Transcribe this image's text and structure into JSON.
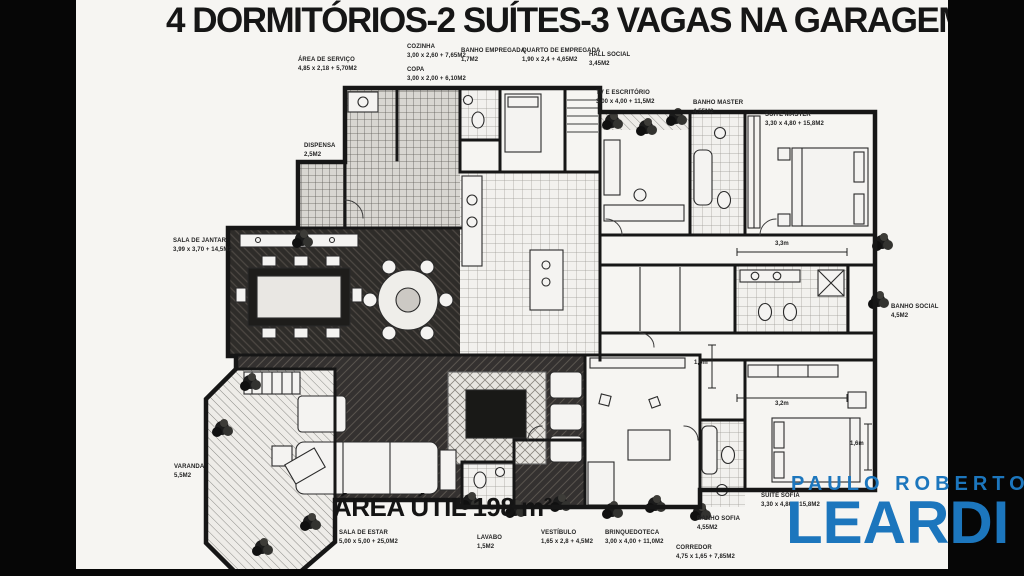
{
  "page": {
    "title": "4 DORMITÓRIOS-2 SUÍTES-3 VAGAS NA GARAGEM",
    "area_util": "ÁREA ÚTIL 198 m²"
  },
  "branding": {
    "line1": "PAULO ROBERTO",
    "line2": "LEARDI"
  },
  "colors": {
    "brand_blue": "#1c76bd",
    "letterbox": "#060606",
    "ink": "#1a1a1a"
  },
  "rooms": {
    "area_servico": {
      "name": "ÁREA DE SERVIÇO",
      "dims": "4,85 x 2,18 + 5,70M2"
    },
    "cozinha": {
      "name": "COZINHA",
      "dims": "3,00 x 2,60 + 7,65M2"
    },
    "copa": {
      "name": "COPA",
      "dims": "3,00 x 2,00 + 6,10M2"
    },
    "banho_empregada": {
      "name": "BANHO EMPREGADA",
      "dims": "1,7M2"
    },
    "quarto_empregada": {
      "name": "QUARTO DE EMPREGADA",
      "dims": "1,90 x 2,4 + 4,65M2"
    },
    "hall_social": {
      "name": "HALL SOCIAL",
      "dims": "3,45M2"
    },
    "tv_escritorio": {
      "name": "TV E ESCRITÓRIO",
      "dims": "3,00 x 4,00 + 11,5M2"
    },
    "banho_master": {
      "name": "BANHO MASTER",
      "dims": "4,55M2"
    },
    "suite_master": {
      "name": "SUITE MASTER",
      "dims": "3,30 x 4,80 + 15,8M2"
    },
    "dispensa": {
      "name": "DISPENSA",
      "dims": "2,5M2"
    },
    "sala_jantar": {
      "name": "SALA DE JANTAR",
      "dims": "3,99 x 3,70 + 14,5M2"
    },
    "banho_social": {
      "name": "BANHO SOCIAL",
      "dims": "4,5M2"
    },
    "varanda": {
      "name": "VARANDA",
      "dims": "5,5M2"
    },
    "sala_estar": {
      "name": "SALA DE ESTAR",
      "dims": "5,00 x 5,00 + 25,0M2"
    },
    "lavabo": {
      "name": "LAVABO",
      "dims": "1,5M2"
    },
    "vestibulo": {
      "name": "VESTÍBULO",
      "dims": "1,65 x 2,8 + 4,5M2"
    },
    "brinquedoteca": {
      "name": "BRINQUEDOTECA",
      "dims": "3,00 x 4,00 + 11,0M2"
    },
    "corredor": {
      "name": "CORREDOR",
      "dims": "4,75 x 1,65 + 7,85M2"
    },
    "banho_sofia": {
      "name": "BANHO SOFIA",
      "dims": "4,55M2"
    },
    "suite_sofia": {
      "name": "SUITE SOFIA",
      "dims": "3,30 x 4,80 + 15,8M2"
    }
  },
  "measurements": {
    "m1": "3,3m",
    "m2": "1,6m",
    "m3": "3,2m",
    "m4": "1,6m"
  }
}
